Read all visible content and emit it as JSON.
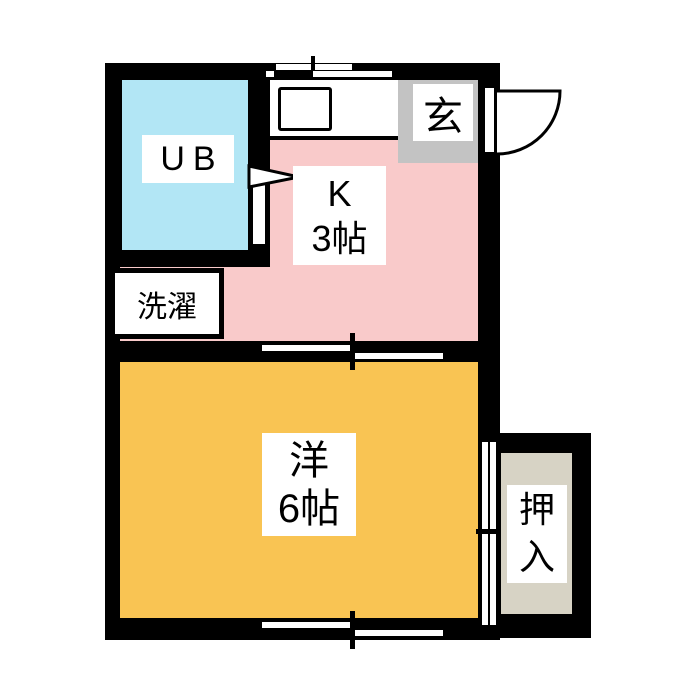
{
  "floorplan": {
    "type": "japanese-apartment-floor-plan",
    "wall_color": "#000000",
    "background_color": "#ffffff",
    "rooms": {
      "ub": {
        "label": "UB",
        "color": "#b2e6f5"
      },
      "kitchen": {
        "label": "K",
        "size": "3帖",
        "color": "#f9caca"
      },
      "genkan": {
        "label": "玄",
        "color": "#c3c3c3"
      },
      "laundry": {
        "label": "洗濯"
      },
      "western": {
        "label": "洋",
        "size": "6帖",
        "color": "#f9c453"
      },
      "closet": {
        "label_top": "押",
        "label_bottom": "入",
        "color": "#d7d3c5"
      }
    }
  }
}
